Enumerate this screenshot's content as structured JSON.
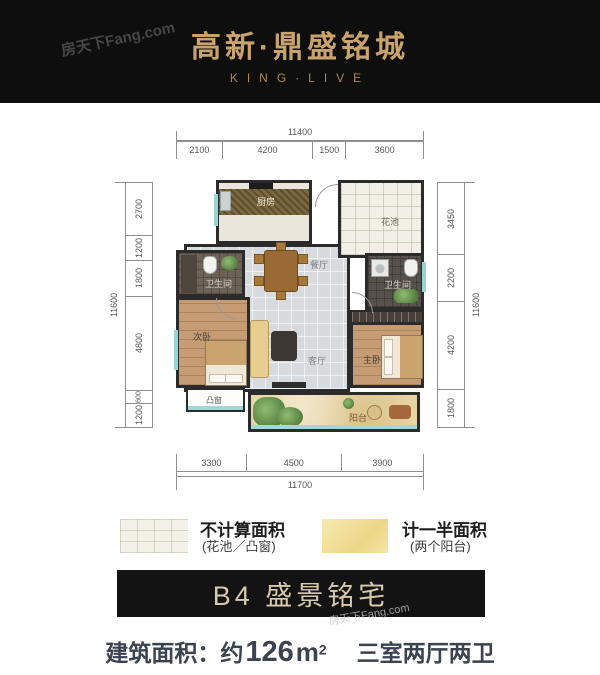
{
  "header": {
    "title": "高新·鼎盛铭城",
    "subtitle": "KING·LIVE",
    "watermark": "房天下Fang.com"
  },
  "floorplan": {
    "dims_top": {
      "total": "11400",
      "segments": [
        "2100",
        "4200",
        "1500",
        "3600"
      ]
    },
    "dims_left": {
      "total": "11600",
      "segments": [
        "2700",
        "1200",
        "1800",
        "4800",
        "600",
        "1200"
      ]
    },
    "dims_right": {
      "total": "11600",
      "segments": [
        "3450",
        "2200",
        "4200",
        "1800"
      ]
    },
    "dims_bottom": {
      "total": "11700",
      "segments": [
        "3300",
        "4500",
        "3900"
      ]
    },
    "rooms": {
      "kitchen": "厨房",
      "flower_pond": "花池",
      "dining": "餐厅",
      "bath_left": "卫生间",
      "bath_right": "卫生间",
      "bedroom_second": "次卧",
      "living": "客厅",
      "bedroom_master": "主卧",
      "bay_window": "凸窗",
      "balcony": "阳台"
    }
  },
  "legend": {
    "items": [
      {
        "label": "不计算面积",
        "sub": "(花池／凸窗)"
      },
      {
        "label": "计一半面积",
        "sub": "(两个阳台)"
      }
    ]
  },
  "banner": {
    "title": "B4 盛景铭宅"
  },
  "footer": {
    "area_label": "建筑面积：",
    "area_approx": "约",
    "area_value": "126",
    "area_unit": "m",
    "area_sup": "2",
    "layout": "三室两厅两卫"
  },
  "colors": {
    "header_bg": "#0e0e0e",
    "gold": "#c9a36b",
    "banner_text": "#d9c9ac",
    "footer_text": "#3b4250",
    "wall": "#2b2b2b",
    "window_teal": "#97d6d2"
  }
}
